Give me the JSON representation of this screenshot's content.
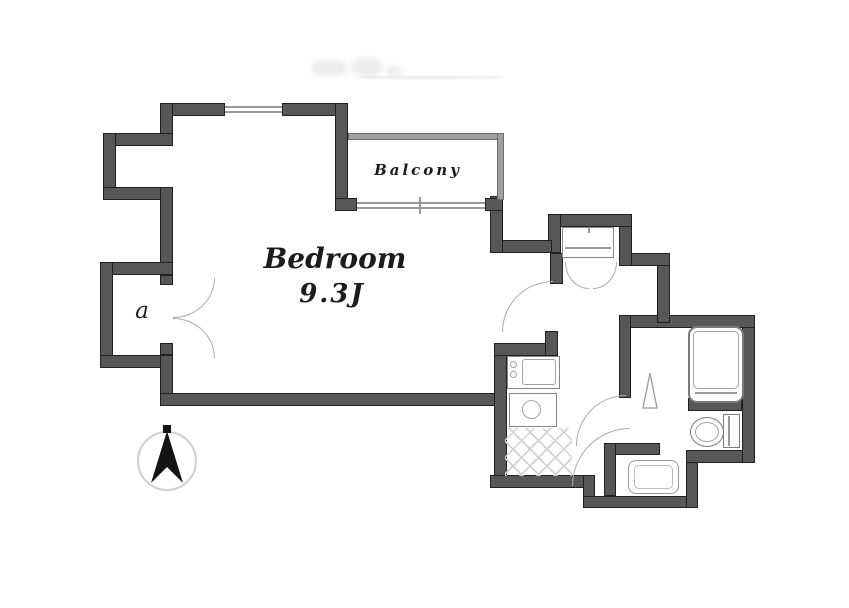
{
  "rooms": {
    "bedroom": {
      "name": "Bedroom",
      "size": "9.3J"
    },
    "balcony": {
      "name": "Balcony"
    },
    "closet": {
      "label": "a"
    }
  },
  "fixtures": {
    "washing_machine": "washing-machine",
    "kitchen_sink": "kitchen-sink-unit",
    "stove": "single-burner-stove",
    "bathtub": "bathtub",
    "toilet": "toilet-with-tank",
    "washbasin": "washbasin",
    "entry_floor": "genkan-tile-floor",
    "compass": "north-arrow-compass"
  },
  "colors": {
    "wall": "#575757",
    "wall_outline": "#212121",
    "railing": "#a0a0a0",
    "window_line": "#9a9a9a",
    "door_arc": "#ababab",
    "fixture_line": "#868686",
    "tile_line": "#d2d2d2",
    "text": "#1c1c1c",
    "compass_arrow": "#141414",
    "background": "#ffffff"
  }
}
